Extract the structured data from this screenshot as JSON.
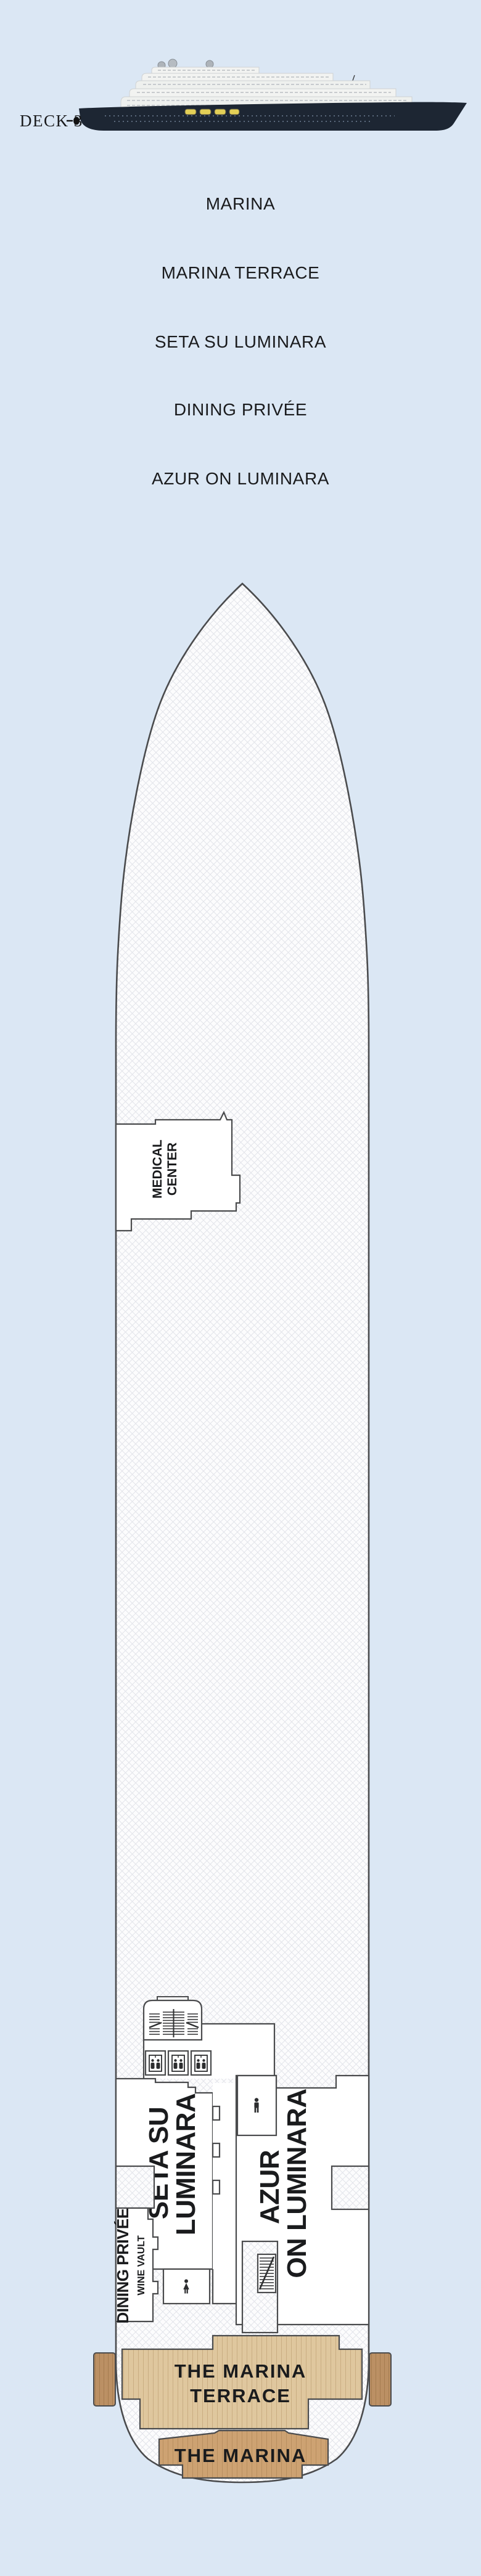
{
  "header": {
    "deck_label": "DECK 3"
  },
  "venues": {
    "items": [
      "MARINA",
      "MARINA TERRACE",
      "SETA SU LUMINARA",
      "DINING PRIVÉE",
      "AZUR ON LUMINARA"
    ]
  },
  "rooms": {
    "medical": {
      "line1": "MEDICAL",
      "line2": "CENTER"
    },
    "seta": {
      "line1": "SETA SU",
      "line2": "LUMINARA"
    },
    "azur": {
      "line1": "AZUR",
      "line2": "ON LUMINARA"
    },
    "dining_privee": {
      "label": "DINING PRIVÉE"
    },
    "wine_vault": {
      "label": "WINE VAULT"
    },
    "marina_terrace": {
      "line1": "THE MARINA",
      "line2": "TERRACE"
    },
    "marina": {
      "label": "THE MARINA"
    }
  },
  "icons": {
    "elevator": "elevator-icon",
    "grand_staircase": "grand-staircase-icon",
    "staircase": "staircase-icon",
    "male_restroom": "male-restroom-icon",
    "female_restroom": "female-restroom-icon",
    "radar_dome": "radar-dome-icon",
    "deck_marker_dot": "deck-marker-dot-icon"
  },
  "colors": {
    "background": "#dbe7f4",
    "plan_outline": "#4a4b4d",
    "hatch_line": "#e3e5ea",
    "plan_fill": "#fcfcfd",
    "room_fill": "#ffffff",
    "wood_light": "#dfc79e",
    "wood_light_line": "#c9ad82",
    "wood_mid": "#cda272",
    "wood_mid_line": "#b88f60",
    "wood_dark": "#bb9064",
    "wood_dark_line": "#a57c50",
    "ship_hull": "#1d2633",
    "superstructure": "#f2f3f1",
    "lifeboat": "#e3cf56",
    "label_color": "#1a1b1d"
  }
}
